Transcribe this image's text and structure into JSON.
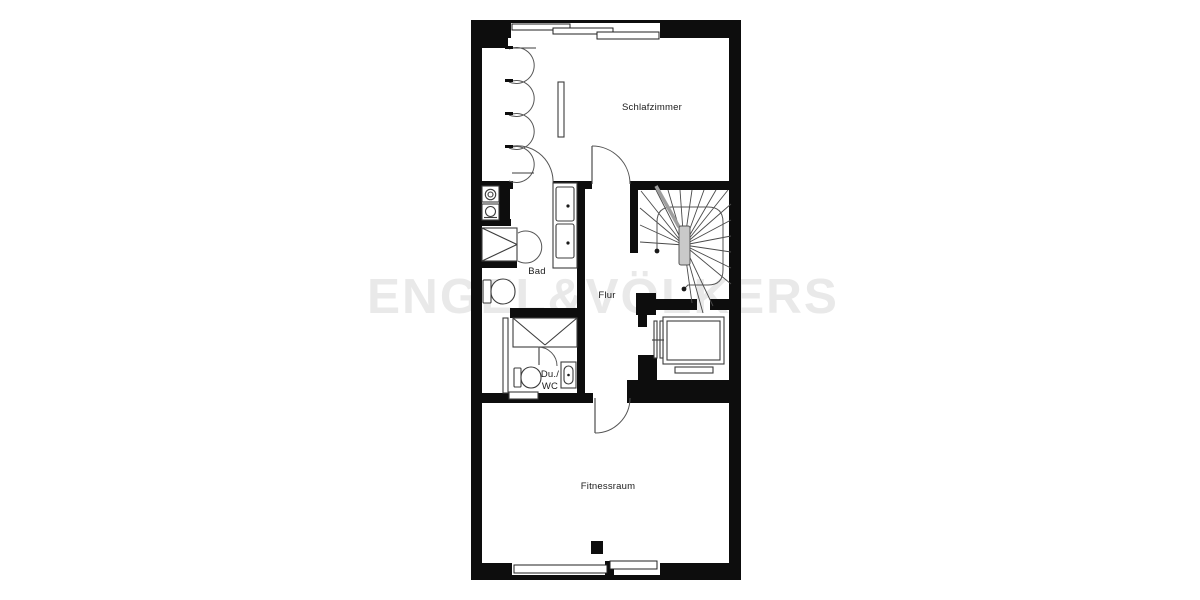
{
  "watermark": {
    "text": "ENGEL&VÖLKERS"
  },
  "rooms": {
    "schlafzimmer": {
      "label": "Schlafzimmer"
    },
    "bad": {
      "label": "Bad"
    },
    "flur": {
      "label": "Flur"
    },
    "du_wc": {
      "label_line1": "Du./",
      "label_line2": "WC"
    },
    "fitnessraum": {
      "label": "Fitnessraum"
    }
  },
  "colors": {
    "wall": "#0d0d0d",
    "background": "#ffffff",
    "fixture": "#3c3c3c",
    "watermark": "#e9e9e9",
    "stair_detail": "#9e9e9e"
  },
  "fixtures": [
    "sliding-window",
    "wardrobe",
    "washing-machine",
    "dryer",
    "shower",
    "toilet",
    "double-washbasin",
    "hand-basin",
    "winder-staircase",
    "sauna",
    "sauna-heater",
    "sauna-bench",
    "radiator",
    "column",
    "door"
  ]
}
